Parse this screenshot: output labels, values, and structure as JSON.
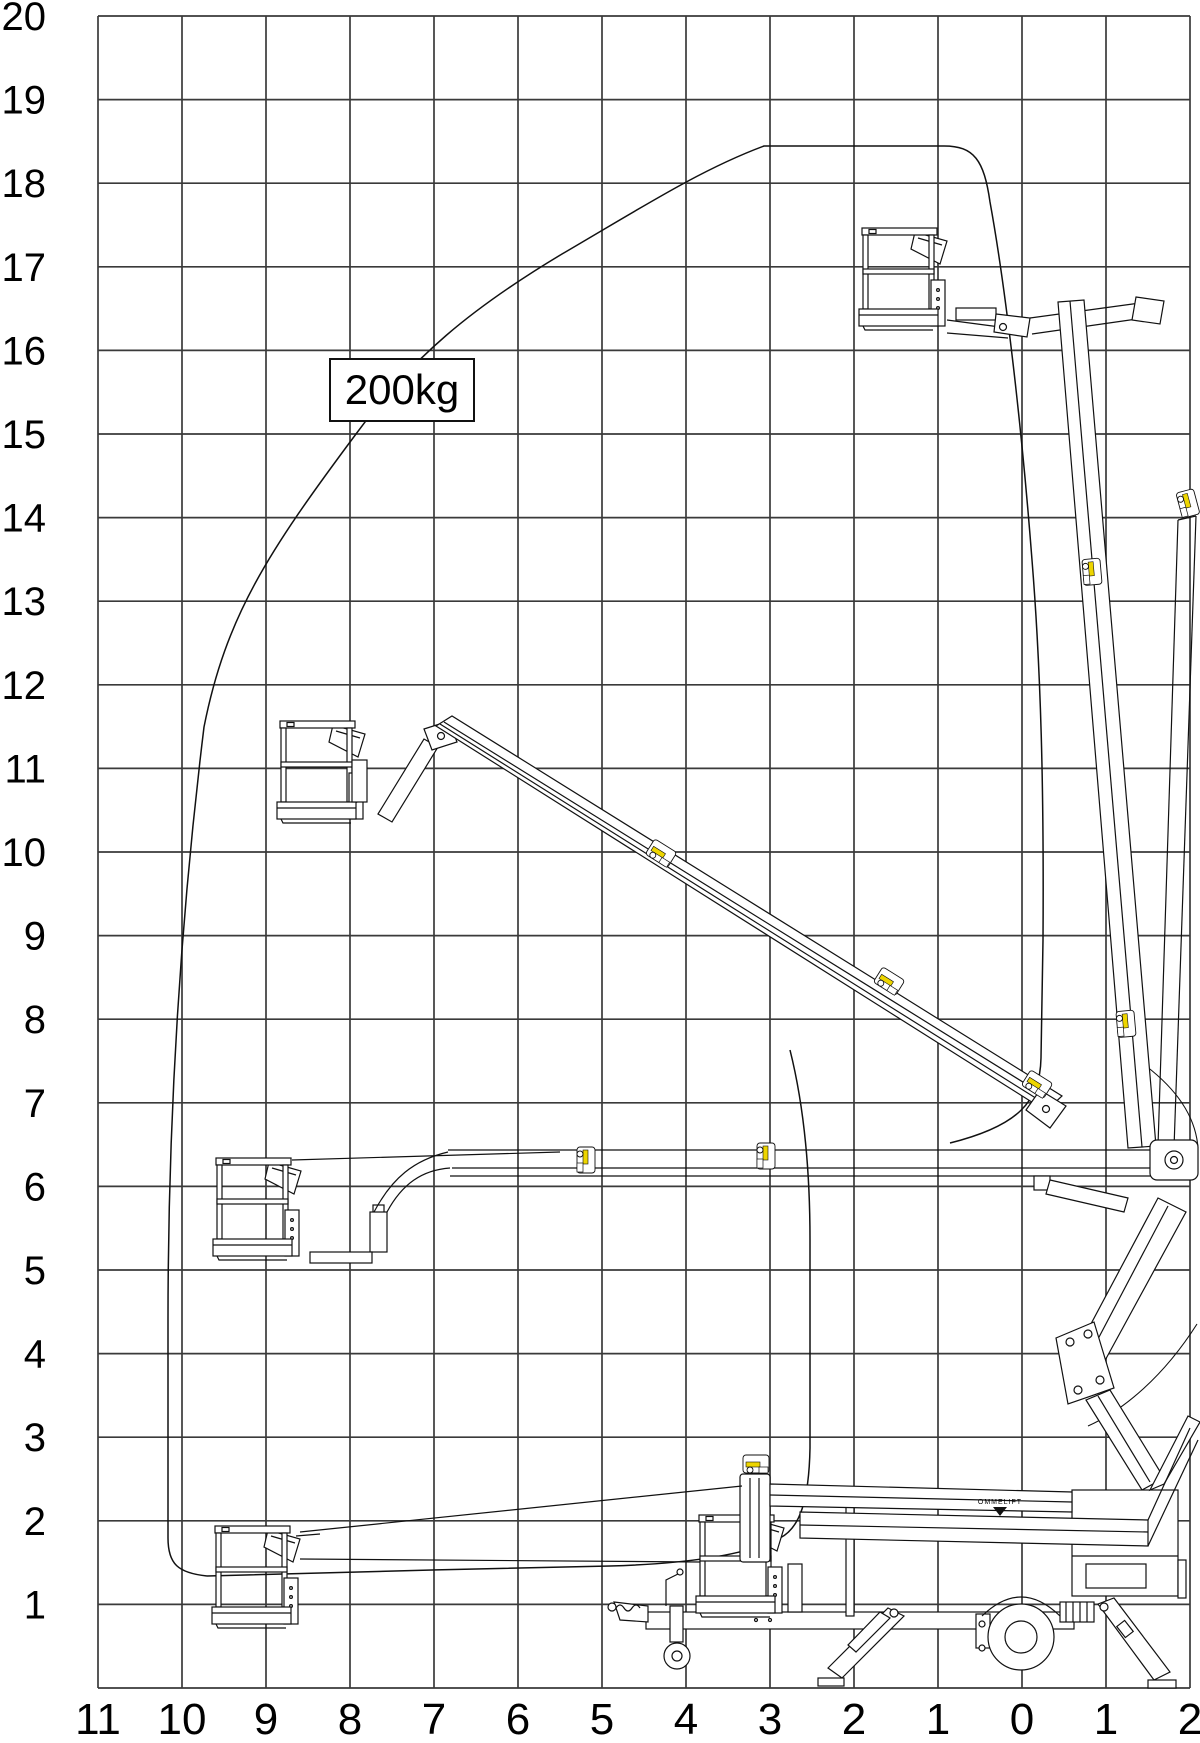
{
  "diagram": {
    "type": "working-envelope reach diagram",
    "machine": "trailer-mounted articulated telescopic boom lift"
  },
  "load_capacity": {
    "label": "200kg"
  },
  "brand": {
    "label": "OMMELIFT"
  },
  "y_axis": {
    "labels": [
      "20",
      "19",
      "18",
      "17",
      "16",
      "15",
      "14",
      "13",
      "12",
      "11",
      "10",
      "9",
      "8",
      "7",
      "6",
      "5",
      "4",
      "3",
      "2",
      "1"
    ]
  },
  "x_axis": {
    "labels": [
      "11",
      "10",
      "9",
      "8",
      "7",
      "6",
      "5",
      "4",
      "3",
      "2",
      "1",
      "0",
      "1",
      "2"
    ]
  },
  "envelope": {
    "capacity_label": "200kg",
    "max_height_m": 18.4,
    "max_outreach_m": 10.2,
    "approx_outline_outreach_height_m": [
      [
        9.7,
        1.35
      ],
      [
        10.2,
        1.55
      ],
      [
        10.2,
        7.0
      ],
      [
        9.8,
        9.2
      ],
      [
        8.6,
        11.5
      ],
      [
        7.1,
        14.3
      ],
      [
        5.2,
        16.6
      ],
      [
        3.1,
        18.4
      ],
      [
        0.9,
        18.4
      ],
      [
        0.4,
        17.8
      ],
      [
        -0.1,
        15.3
      ],
      [
        -0.25,
        8.9
      ],
      [
        -0.2,
        7.5
      ],
      [
        0.85,
        6.5
      ]
    ]
  },
  "poses": {
    "platform_heights_m": [
      17.5,
      11.6,
      6.3,
      1.9
    ],
    "stowed": "basket stowed on trailer deck"
  }
}
